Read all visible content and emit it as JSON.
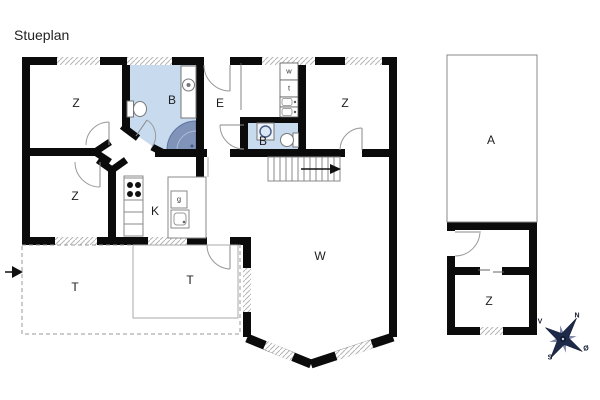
{
  "title": "Stueplan",
  "rooms": {
    "bedroom_top_left": "Z",
    "bathroom_main": "B",
    "entry": "E",
    "bedroom_top_right": "Z",
    "bathroom_small": "B",
    "bedroom_bottom_left": "Z",
    "kitchen": "K",
    "living_room": "W",
    "terrace_left": "T",
    "terrace_right": "T",
    "annex_carport": "A",
    "annex_bedroom": "Z"
  },
  "appliances": {
    "washer": "w",
    "dryer": "t",
    "fridge": "g"
  },
  "compass": {
    "north": "N",
    "east": "Ø",
    "south": "S",
    "west": "V"
  },
  "colors": {
    "wall": "#0b0b0b",
    "bathroom_fill": "#c7daee",
    "shower_fill": "#8094ba",
    "fixture_line": "#888888",
    "window_hatch": "#b5b5b5",
    "compass_dark": "#1e2a4a"
  }
}
